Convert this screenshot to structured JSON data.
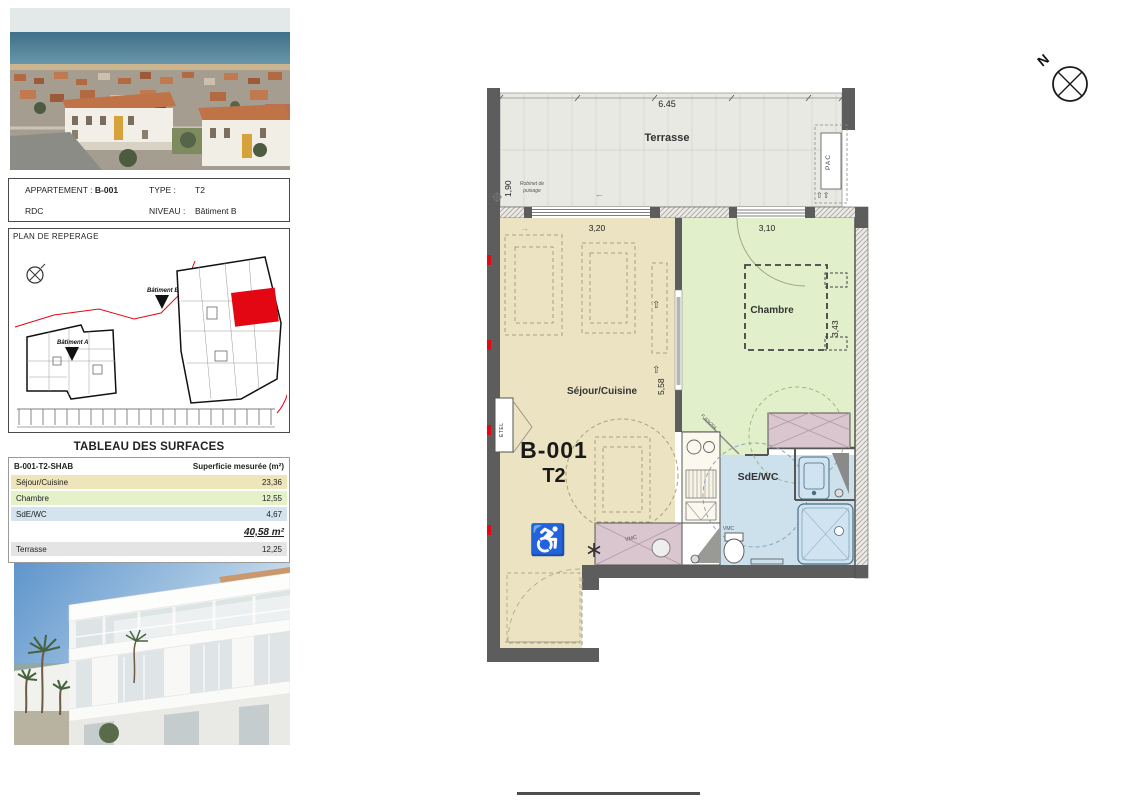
{
  "apartment_card": {
    "appartement_label": "APPARTEMENT :",
    "appartement_value": "B-001",
    "type_label": "TYPE :",
    "type_value": "T2",
    "floor_label": "RDC",
    "niveau_label": "NIVEAU :",
    "niveau_value": "Bâtiment B"
  },
  "reperage": {
    "title": "PLAN DE REPERAGE",
    "batiment_a": "Bâtiment A",
    "batiment_b": "Bâtiment B"
  },
  "surface_table": {
    "title": "TABLEAU DES SURFACES",
    "header_left": "B-001-T2-SHAB",
    "header_right": "Superficie mesurée (m²)",
    "rows": [
      {
        "label": "Séjour/Cuisine",
        "value": "23,36",
        "color": "#efe5ba"
      },
      {
        "label": "Chambre",
        "value": "12,55",
        "color": "#e4f1c9"
      },
      {
        "label": "SdE/WC",
        "value": "4,67",
        "color": "#d3e4ef"
      }
    ],
    "total": "40,58 m²",
    "terrace_row": {
      "label": "Terrasse",
      "value": "12,25",
      "color": "#e4e4e4"
    }
  },
  "floorplan": {
    "unit_code": "B-001",
    "unit_type": "T2",
    "room_terrasse": "Terrasse",
    "room_sejour": "Séjour/Cuisine",
    "room_chambre": "Chambre",
    "room_sde": "SdE/WC",
    "dim_terrasse_w": "6.45",
    "dim_terrasse_d": "1,90",
    "dim_sejour_w": "3,20",
    "dim_chambre_w": "3,10",
    "dim_sejour_h": "5,58",
    "dim_chambre_h": "3,43",
    "ann_robinet": "Robinet de puisage",
    "ann_pac": "PAC",
    "ann_etel": "ETEL",
    "ann_vmc": "VMC",
    "ann_door": "P. 63x204",
    "north": "N"
  },
  "icons": {
    "wheelchair": "♿",
    "slide_arrow": "⇧",
    "left_arrow": "←",
    "right_arrow": "→"
  },
  "colors": {
    "sejour": "#ebe3c1",
    "chambre": "#e1efca",
    "sde": "#cde1ec",
    "terrace": "#e9e9e4",
    "closet": "#d9c6cf",
    "wall": "#5d5d5d",
    "unit_red": "#e30613"
  }
}
